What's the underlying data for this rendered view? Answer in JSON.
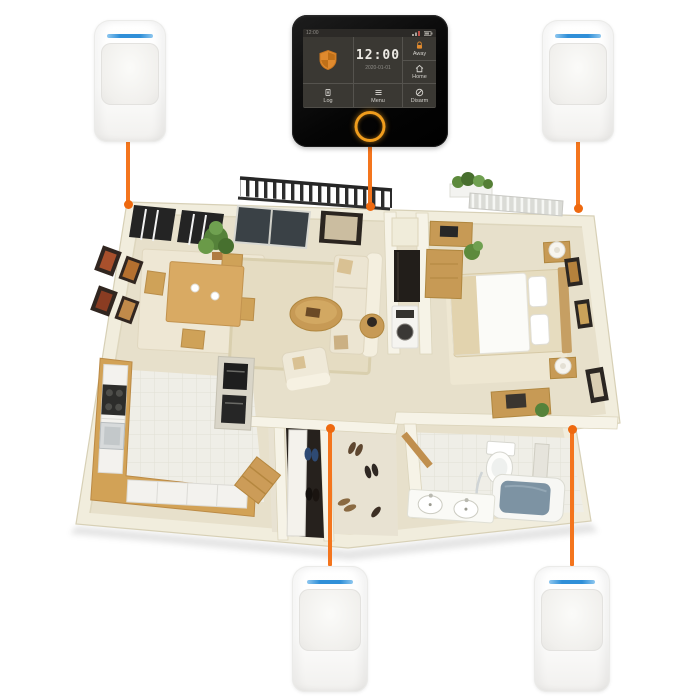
{
  "scene": {
    "title": "wireless-security-system-floorplan",
    "background": "#ffffff",
    "accent_color": "#f4751d",
    "sensor_led_color": "#2f8fd8"
  },
  "panel": {
    "statusbar": {
      "time": "12:00"
    },
    "clock": {
      "time": "12:00",
      "date": "2020-01-01"
    },
    "buttons": {
      "away": {
        "label": "Away",
        "icon": "away-lock-icon"
      },
      "home": {
        "label": "Home",
        "icon": "home-icon"
      },
      "log": {
        "label": "Log",
        "icon": "log-icon"
      },
      "menu": {
        "label": "Menu",
        "icon": "menu-icon"
      },
      "disarm": {
        "label": "Disarm",
        "icon": "disarm-icon"
      }
    },
    "shield_icon": "security-shield-icon",
    "colors": {
      "body": "#0b0b0b",
      "screen": "#3a3833",
      "accent": "#e18a2e",
      "ring_button": "#f09d1d"
    }
  },
  "sensors": [
    {
      "id": "pir-sensor-top-left",
      "position": "top-left"
    },
    {
      "id": "pir-sensor-top-right",
      "position": "top-right"
    },
    {
      "id": "pir-sensor-bottom-center",
      "position": "bottom-center"
    },
    {
      "id": "pir-sensor-bottom-right",
      "position": "bottom-right"
    }
  ],
  "connections": [
    {
      "from": "pir-sensor-top-left",
      "to": "floorplan-dining-corner"
    },
    {
      "from": "control-panel",
      "to": "floorplan-living-wall"
    },
    {
      "from": "pir-sensor-top-right",
      "to": "floorplan-bedroom-corner"
    },
    {
      "from": "floorplan-entry-closet",
      "to": "pir-sensor-bottom-center"
    },
    {
      "from": "floorplan-bathroom-corner",
      "to": "pir-sensor-bottom-right"
    }
  ],
  "floorplan": {
    "areas": [
      "balcony",
      "dining-area",
      "living-room",
      "hallway",
      "bedroom",
      "kitchen",
      "entry-closet",
      "bathroom"
    ]
  }
}
